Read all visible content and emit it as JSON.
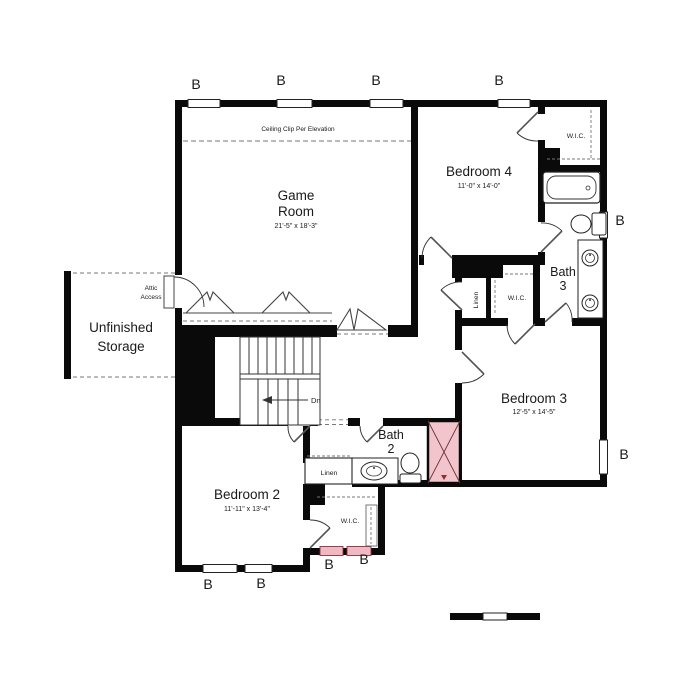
{
  "floor_plan": {
    "rooms": {
      "game_room": {
        "name_line1": "Game",
        "name_line2": "Room",
        "dims": "21'-5\" x 18'-3\""
      },
      "bedroom4": {
        "name": "Bedroom 4",
        "dims": "11'-0\" x 14'-0\""
      },
      "bedroom3": {
        "name": "Bedroom 3",
        "dims": "12'-5\" x 14'-5\""
      },
      "bedroom2": {
        "name": "Bedroom 2",
        "dims": "11'-11\" x 13'-4\""
      },
      "bath3": {
        "name_line1": "Bath",
        "name_line2": "3"
      },
      "bath2": {
        "name_line1": "Bath",
        "name_line2": "2"
      },
      "unfinished_storage": {
        "name_line1": "Unfinished",
        "name_line2": "Storage"
      }
    },
    "labels": {
      "wic": "W.I.C.",
      "linen": "Linen",
      "attic_access_line1": "Attic",
      "attic_access_line2": "Access",
      "ceiling_clip": "Ceiling Clip Per Elevation",
      "stairs_down": "Dn",
      "window_marker": "B"
    },
    "colors": {
      "marker_red": "#c0392b",
      "shower_pink": "#f2c4cc",
      "window_pink": "#f0b8c2",
      "wall_black": "#0a0a0a"
    }
  }
}
